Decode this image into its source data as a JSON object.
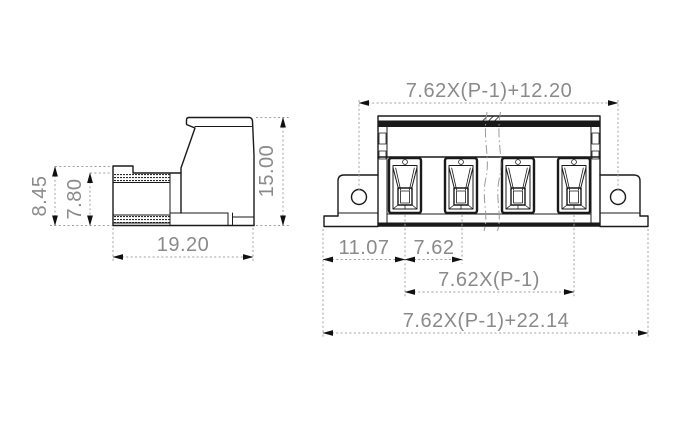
{
  "colors": {
    "outline": "#1a1a1a",
    "dimline": "#a0a0a0",
    "dimtext": "#8a8a8a",
    "arrow": "#111111",
    "bg": "#ffffff"
  },
  "views": {
    "side": {
      "dims": {
        "height_step": "8.45",
        "height_body": "7.80",
        "depth": "19.20",
        "height_total": "15.00"
      }
    },
    "front": {
      "pole_count": 4,
      "dims": {
        "mount_hole_span": "7.62X(P-1)+12.20",
        "first_pole_offset": "11.07",
        "pole_pitch": "7.62",
        "pole_span": "7.62X(P-1)",
        "overall_width": "7.62X(P-1)+22.14"
      }
    }
  }
}
